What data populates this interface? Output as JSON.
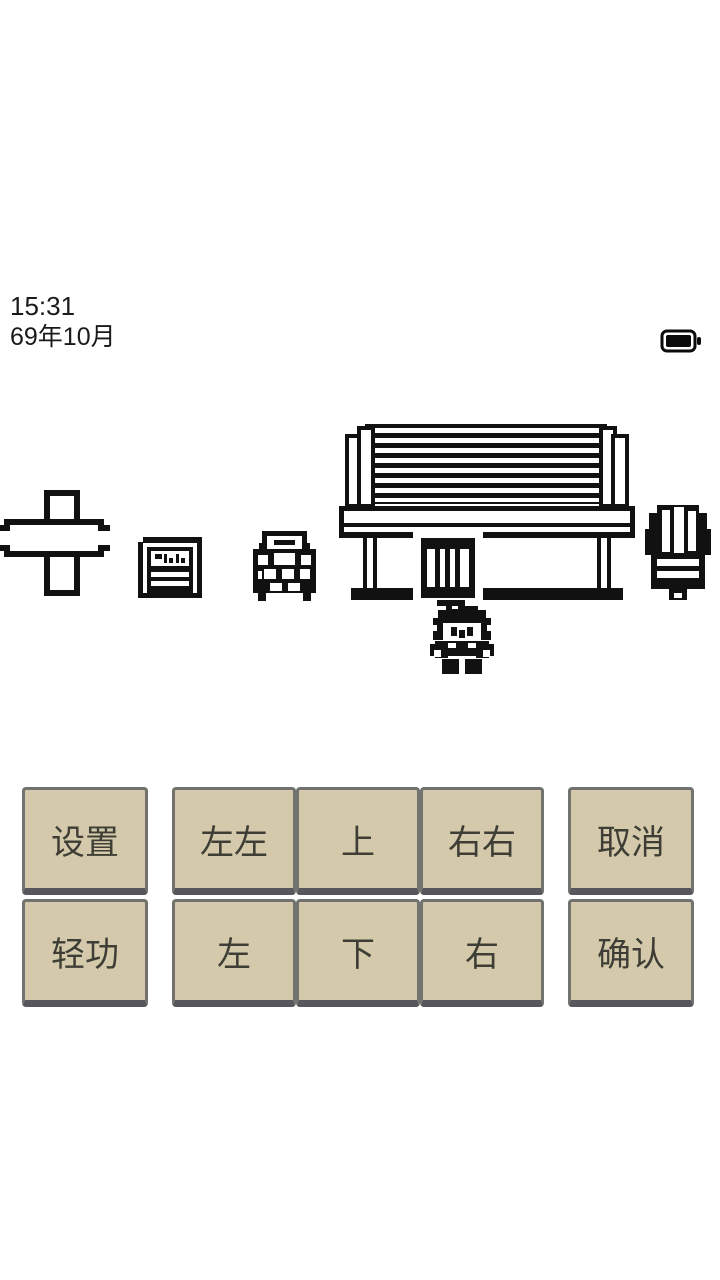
{
  "status": {
    "time": "15:31",
    "date": "69年10月"
  },
  "scene": {
    "sprites": [
      "signpost",
      "notice-board",
      "bush",
      "house",
      "player",
      "tree"
    ]
  },
  "buttons": {
    "settings": "设置",
    "lightfoot": "轻功",
    "left_double": "左左",
    "up": "上",
    "right_double": "右右",
    "left": "左",
    "down": "下",
    "right": "右",
    "cancel": "取消",
    "confirm": "确认"
  },
  "colors": {
    "button_bg": "#d4caab",
    "button_border": "#72726f",
    "button_shadow": "#56565c",
    "sprite_ink": "#111111",
    "background": "#ffffff"
  }
}
